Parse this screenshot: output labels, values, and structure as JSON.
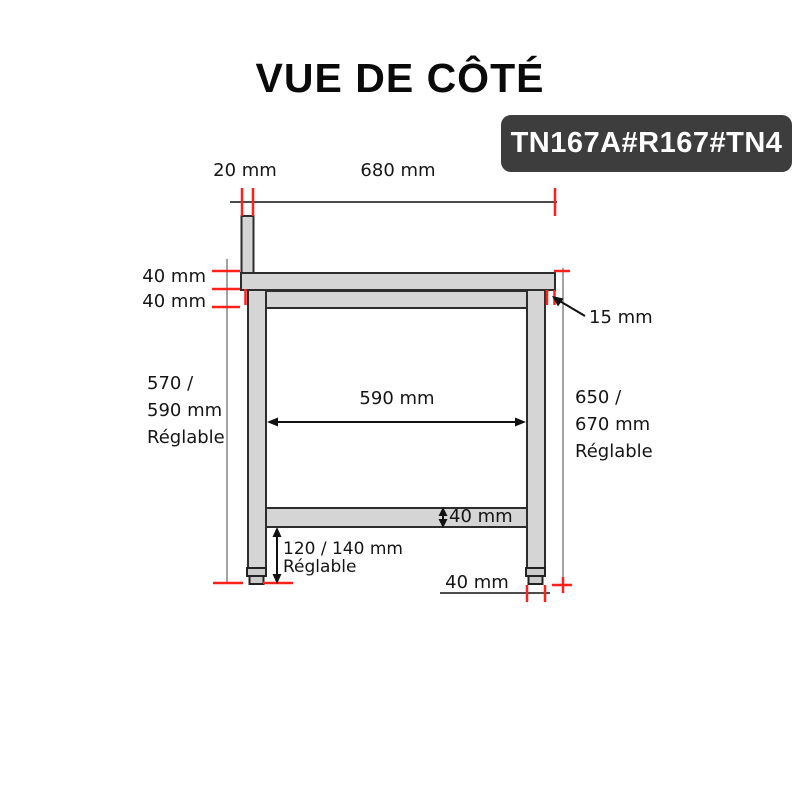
{
  "title": "VUE DE CÔTÉ",
  "badge": {
    "code": "TN167A#R167#TN4"
  },
  "colors": {
    "steel_fill": "#d5d5d5",
    "steel_stroke": "#2d2d2d",
    "tick_red": "#ff2019",
    "ink": "#111111",
    "badge_bg": "#3d3d3d",
    "badge_text": "#ffffff"
  },
  "labels": {
    "backsplash_width": "20 mm",
    "top_depth": "680 mm",
    "top_thickness": "40 mm",
    "frame_height": "40 mm",
    "left_clearance": [
      "570 /",
      "590 mm",
      "Réglable"
    ],
    "inner_width": "590 mm",
    "right_height": [
      "650 /",
      "670 mm",
      "Réglable"
    ],
    "edge_overhang": "15 mm",
    "shelf_thickness": "40 mm",
    "foot_height": [
      "120 / 140 mm",
      "Réglable"
    ],
    "foot_width": "40 mm"
  }
}
